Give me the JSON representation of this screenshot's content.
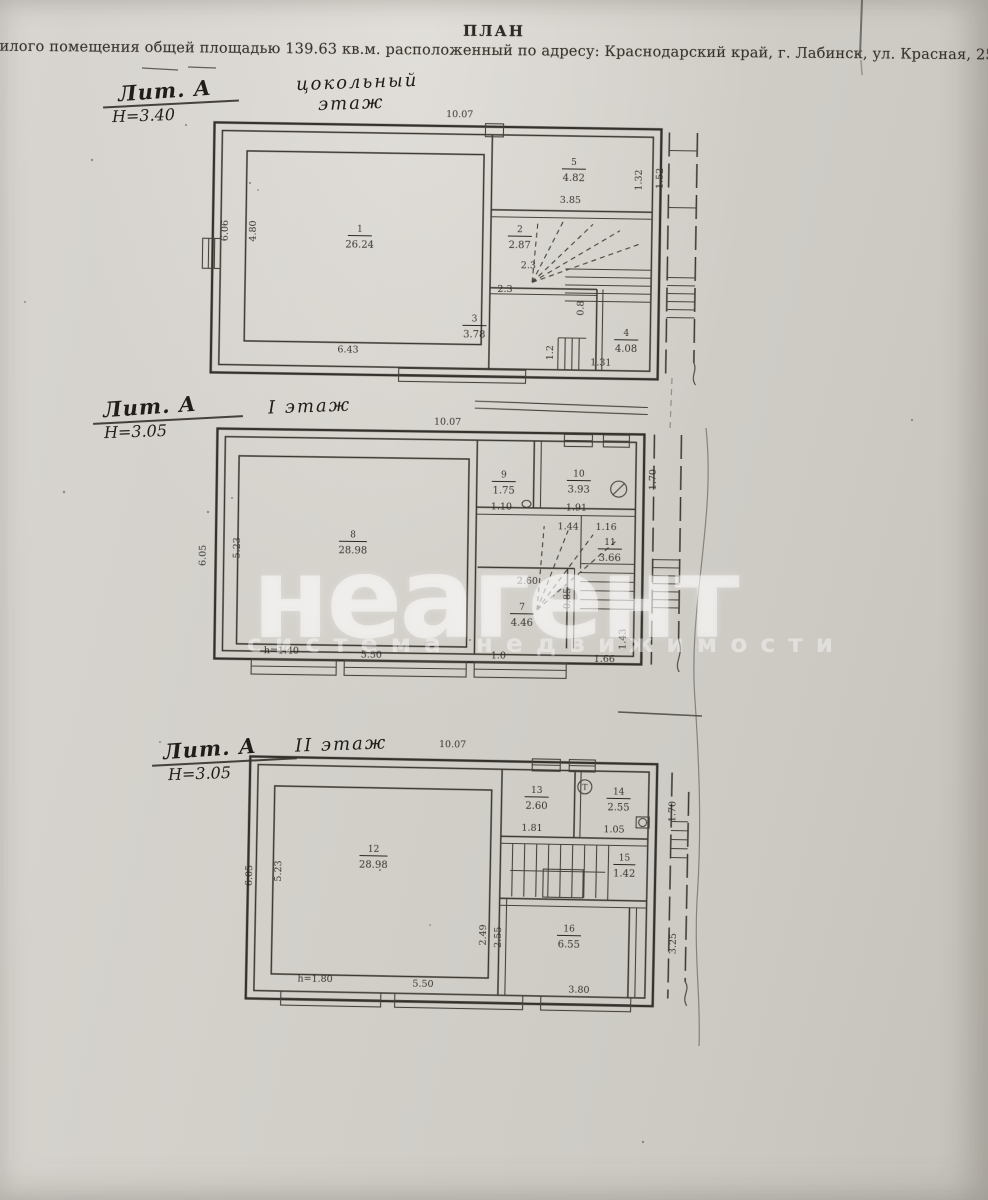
{
  "page": {
    "title": "ПЛАН",
    "subtitle": "жилого помещения общей площадью 139.63 кв.м. расположенный по адресу: Краснодарский край, г. Лабинск, ул. Красная, 25/1.",
    "paper_color": "#d3d0ca",
    "ink_color": "#34312c"
  },
  "watermark": {
    "word": "неагент",
    "tagline": "система недвижимости",
    "color": "#ffffff"
  },
  "plans": [
    {
      "name": "цокольный этаж",
      "lit": "Лит. А",
      "h": "Н=3.40",
      "floor1": "цокольный",
      "floor2": "этаж",
      "top": "10.07",
      "rooms": {
        "r1n": "1",
        "r1a": "26.24",
        "r5n": "5",
        "r5a": "4.82",
        "r2n": "2",
        "r2a": "2.87",
        "r3n": "3",
        "r3a": "3.78",
        "r4n": "4",
        "r4a": "4.08"
      },
      "dims": {
        "w5": "3.85",
        "h5": "1.32",
        "hs": "1.52",
        "w2": "2.3",
        "w3t": "2.3",
        "st": "0.8",
        "s12": "1.2",
        "w4": "1.31",
        "bottom": "6.43",
        "lo": "6.06",
        "li": "4.80"
      }
    },
    {
      "name": "1 этаж",
      "lit": "Лит. А",
      "h": "Н=3.05",
      "floor1": "I этаж",
      "floor2": "",
      "top": "10.07",
      "rooms": {
        "r8n": "8",
        "r8a": "28.98",
        "r9n": "9",
        "r9a": "1.75",
        "r10n": "10",
        "r10a": "3.93",
        "r11n": "11",
        "r11a": "3.66",
        "r7n": "7",
        "r7a": "4.46"
      },
      "dims": {
        "w9": "1.10",
        "w10": "1.91",
        "a11": "1.44",
        "b11": "1.16",
        "t7": "2.60",
        "s7": "0.85",
        "b7a": "1.0",
        "b7b": "1.66",
        "r7r": "1.43",
        "rh": "1.70",
        "lo": "6.05",
        "li": "5.23",
        "hnote": "h=1.40",
        "bw": "5.50"
      }
    },
    {
      "name": "2 этаж",
      "lit": "Лит. А",
      "h": "Н=3.05",
      "floor1": "II этаж",
      "floor2": "",
      "top": "10.07",
      "rooms": {
        "r12n": "12",
        "r12a": "28.98",
        "r13n": "13",
        "r13a": "2.60",
        "r14n": "14",
        "r14a": "2.55",
        "r15n": "15",
        "r15a": "1.42",
        "r16n": "16",
        "r16a": "6.55"
      },
      "dims": {
        "w13": "1.81",
        "w14": "1.05",
        "rh": "1.70",
        "l16a": "2.49",
        "l16b": "2.55",
        "b16": "3.80",
        "rs": "3.25",
        "lo": "6.05",
        "li": "5.23",
        "hnote": "h=1.80",
        "bw1": "5.50"
      }
    }
  ]
}
